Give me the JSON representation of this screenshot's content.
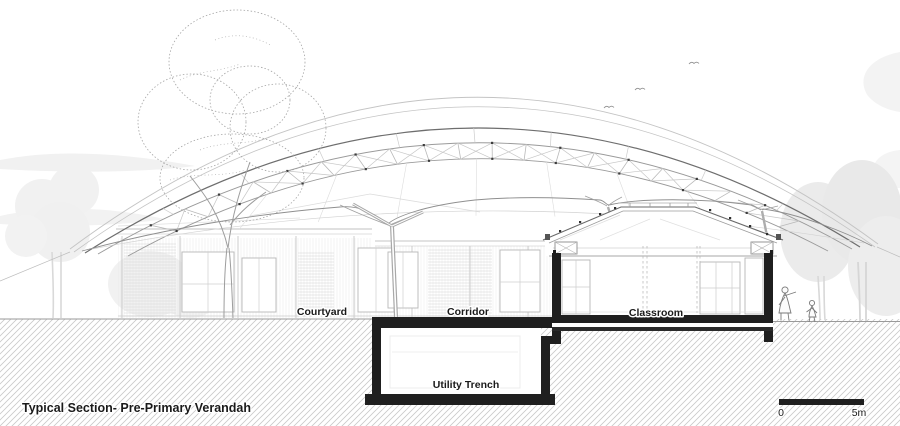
{
  "title": {
    "text": "Typical Section- Pre-Primary Verandah"
  },
  "labels": {
    "courtyard": "Courtyard",
    "corridor": "Corridor",
    "classroom": "Classroom",
    "utility_trench": "Utility Trench"
  },
  "scale_bar": {
    "zero": "0",
    "five_m": "5m"
  },
  "colors": {
    "background": "#ffffff",
    "section_cut_black": "#1f1f1f",
    "line_dark": "#6e6e6e",
    "line_mid": "#9a9a9a",
    "line_light": "#c6c6c6",
    "ground_hatch": "#c9c9c9",
    "tree_faint": "#eeeeee",
    "text": "#1a1a1a"
  },
  "icons": {
    "birds": "bird-icon",
    "trees": "tree-icon",
    "people": "person-figure"
  }
}
